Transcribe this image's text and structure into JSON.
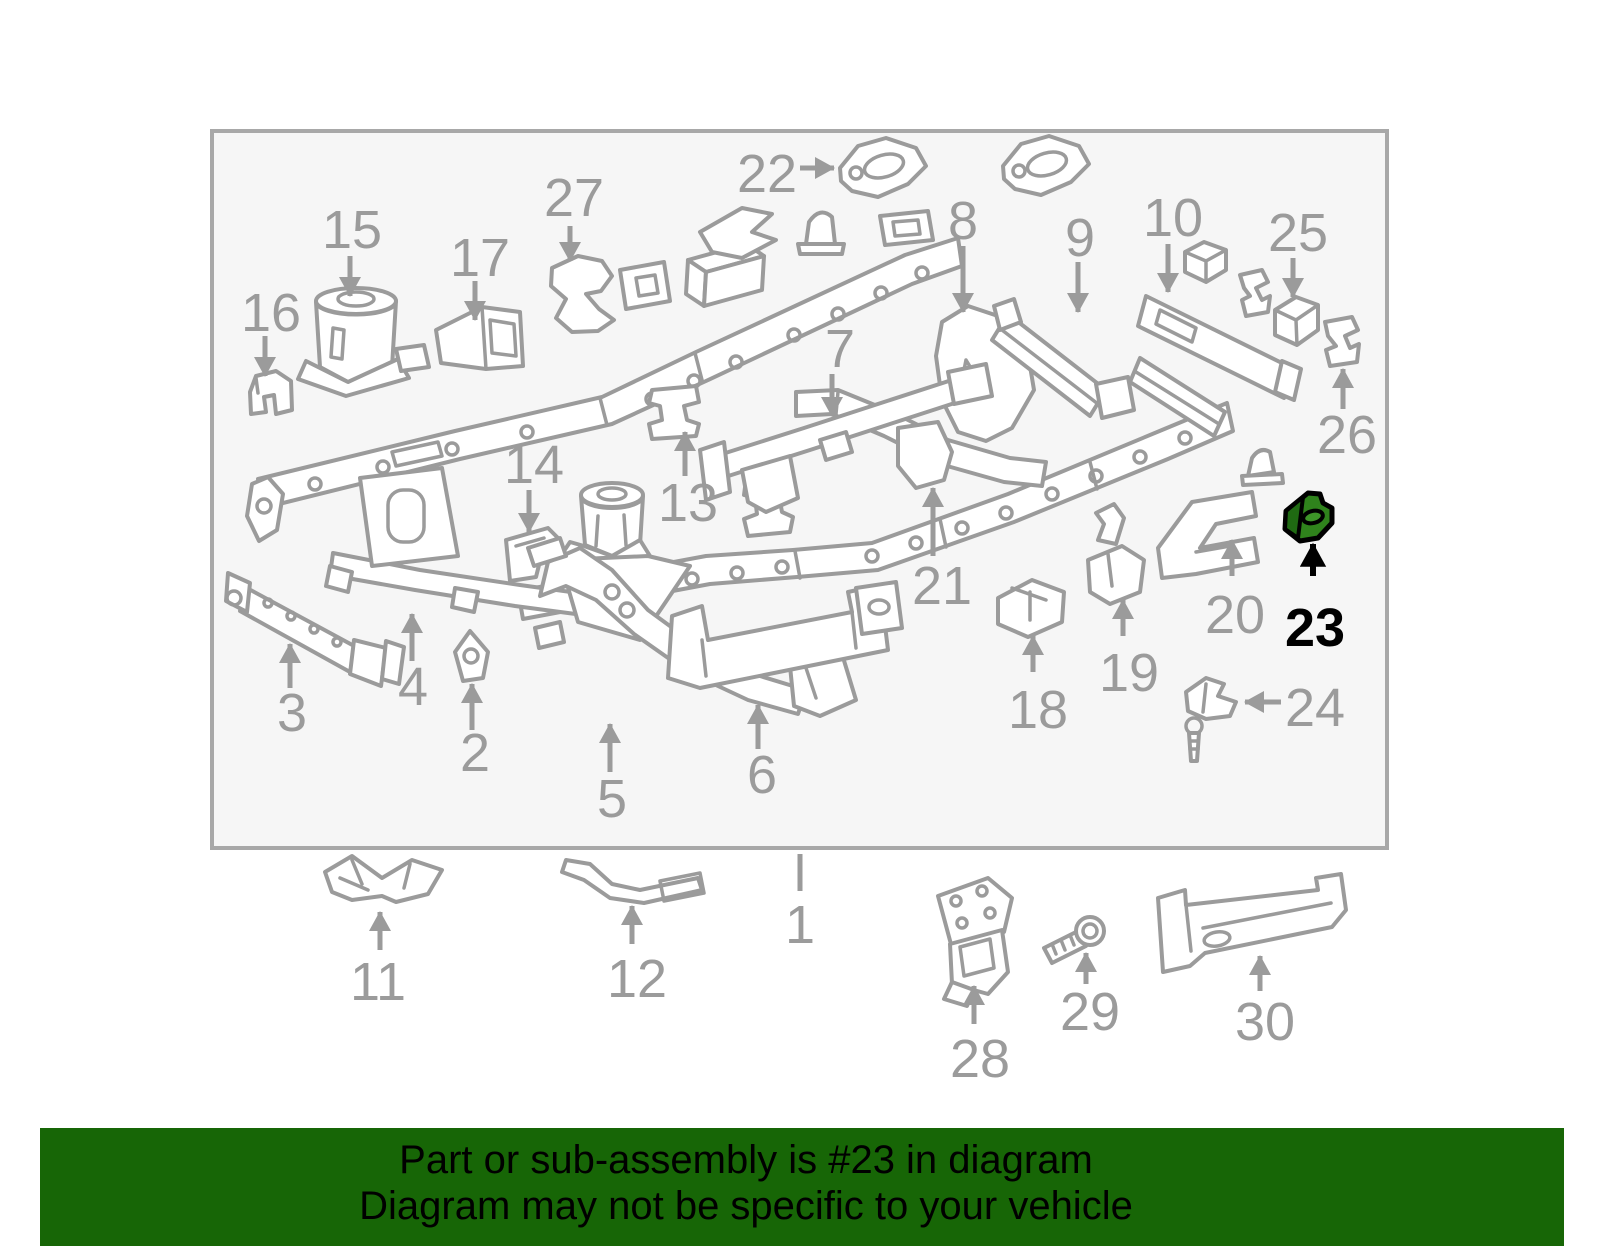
{
  "banner": {
    "line1": "Part or sub-assembly is #23 in diagram",
    "line2": "Diagram may not be specific to your vehicle"
  },
  "colors": {
    "line_gray": "#9B9B9B",
    "frame_border_gray": "#A8A8A8",
    "panel_bg": "#F6F6F6",
    "banner_green": "#176606",
    "highlight_green": "#2F831C",
    "highlight_green_dark": "#1F6A12",
    "highlight_green_mid": "#3D9428",
    "highlight_label_black": "#000000"
  },
  "diagram": {
    "highlighted_part_number": "23",
    "labels": [
      {
        "num": "1",
        "x": 800,
        "y": 924,
        "arrow": {
          "x1": 800,
          "y1": 854,
          "x2": 800,
          "y2": 891
        },
        "head": "none"
      },
      {
        "num": "2",
        "x": 475,
        "y": 752,
        "arrow": {
          "x1": 472,
          "y1": 730,
          "x2": 472,
          "y2": 684
        },
        "head": "end"
      },
      {
        "num": "3",
        "x": 292,
        "y": 712,
        "arrow": {
          "x1": 290,
          "y1": 688,
          "x2": 290,
          "y2": 644
        },
        "head": "end"
      },
      {
        "num": "4",
        "x": 413,
        "y": 686,
        "arrow": {
          "x1": 412,
          "y1": 661,
          "x2": 412,
          "y2": 614
        },
        "head": "end"
      },
      {
        "num": "5",
        "x": 612,
        "y": 798,
        "arrow": {
          "x1": 610,
          "y1": 772,
          "x2": 610,
          "y2": 724
        },
        "head": "end"
      },
      {
        "num": "6",
        "x": 762,
        "y": 774,
        "arrow": {
          "x1": 758,
          "y1": 749,
          "x2": 758,
          "y2": 705
        },
        "head": "end"
      },
      {
        "num": "7",
        "x": 840,
        "y": 348,
        "arrow": {
          "x1": 832,
          "y1": 374,
          "x2": 832,
          "y2": 416
        },
        "head": "end"
      },
      {
        "num": "8",
        "x": 963,
        "y": 220,
        "arrow": {
          "x1": 963,
          "y1": 246,
          "x2": 963,
          "y2": 312
        },
        "head": "end"
      },
      {
        "num": "9",
        "x": 1080,
        "y": 237,
        "arrow": {
          "x1": 1078,
          "y1": 262,
          "x2": 1078,
          "y2": 312
        },
        "head": "end"
      },
      {
        "num": "10",
        "x": 1173,
        "y": 217,
        "arrow": {
          "x1": 1168,
          "y1": 244,
          "x2": 1168,
          "y2": 292
        },
        "head": "end"
      },
      {
        "num": "11",
        "x": 378,
        "y": 981,
        "arrow": {
          "x1": 380,
          "y1": 950,
          "x2": 380,
          "y2": 912
        },
        "head": "end"
      },
      {
        "num": "12",
        "x": 637,
        "y": 978,
        "arrow": {
          "x1": 632,
          "y1": 944,
          "x2": 632,
          "y2": 906
        },
        "head": "end"
      },
      {
        "num": "13",
        "x": 688,
        "y": 502,
        "arrow": {
          "x1": 685,
          "y1": 476,
          "x2": 685,
          "y2": 432
        },
        "head": "end"
      },
      {
        "num": "14",
        "x": 534,
        "y": 464,
        "arrow": {
          "x1": 529,
          "y1": 490,
          "x2": 529,
          "y2": 532
        },
        "head": "end"
      },
      {
        "num": "15",
        "x": 352,
        "y": 229,
        "arrow": {
          "x1": 350,
          "y1": 256,
          "x2": 350,
          "y2": 296
        },
        "head": "end"
      },
      {
        "num": "16",
        "x": 271,
        "y": 312,
        "arrow": {
          "x1": 265,
          "y1": 336,
          "x2": 265,
          "y2": 376
        },
        "head": "end"
      },
      {
        "num": "17",
        "x": 480,
        "y": 257,
        "arrow": {
          "x1": 475,
          "y1": 281,
          "x2": 475,
          "y2": 320
        },
        "head": "end"
      },
      {
        "num": "18",
        "x": 1038,
        "y": 709,
        "arrow": {
          "x1": 1033,
          "y1": 672,
          "x2": 1033,
          "y2": 636
        },
        "head": "end"
      },
      {
        "num": "19",
        "x": 1129,
        "y": 672,
        "arrow": {
          "x1": 1123,
          "y1": 636,
          "x2": 1123,
          "y2": 600
        },
        "head": "end"
      },
      {
        "num": "20",
        "x": 1235,
        "y": 614,
        "arrow": {
          "x1": 1232,
          "y1": 576,
          "x2": 1232,
          "y2": 540
        },
        "head": "end"
      },
      {
        "num": "21",
        "x": 942,
        "y": 585,
        "arrow": {
          "x1": 933,
          "y1": 556,
          "x2": 933,
          "y2": 488
        },
        "head": "end"
      },
      {
        "num": "22",
        "x": 767,
        "y": 173,
        "arrow": {
          "x1": 800,
          "y1": 168,
          "x2": 834,
          "y2": 168
        },
        "head": "end"
      },
      {
        "num": "23",
        "x": 1315,
        "y": 627,
        "arrow": {
          "x1": 1313,
          "y1": 576,
          "x2": 1313,
          "y2": 544
        },
        "head": "end",
        "highlight": true
      },
      {
        "num": "24",
        "x": 1315,
        "y": 707,
        "arrow": {
          "x1": 1281,
          "y1": 702,
          "x2": 1245,
          "y2": 702
        },
        "head": "end"
      },
      {
        "num": "25",
        "x": 1298,
        "y": 232,
        "arrow": {
          "x1": 1293,
          "y1": 258,
          "x2": 1293,
          "y2": 297
        },
        "head": "end"
      },
      {
        "num": "26",
        "x": 1347,
        "y": 434,
        "arrow": {
          "x1": 1343,
          "y1": 409,
          "x2": 1343,
          "y2": 369
        },
        "head": "end"
      },
      {
        "num": "27",
        "x": 574,
        "y": 197,
        "arrow": {
          "x1": 570,
          "y1": 226,
          "x2": 570,
          "y2": 261
        },
        "head": "end"
      },
      {
        "num": "28",
        "x": 980,
        "y": 1058,
        "arrow": {
          "x1": 974,
          "y1": 1024,
          "x2": 974,
          "y2": 986
        },
        "head": "end"
      },
      {
        "num": "29",
        "x": 1090,
        "y": 1011,
        "arrow": {
          "x1": 1086,
          "y1": 984,
          "x2": 1086,
          "y2": 953
        },
        "head": "end"
      },
      {
        "num": "30",
        "x": 1265,
        "y": 1021,
        "arrow": {
          "x1": 1260,
          "y1": 991,
          "x2": 1260,
          "y2": 956
        },
        "head": "end"
      }
    ]
  }
}
